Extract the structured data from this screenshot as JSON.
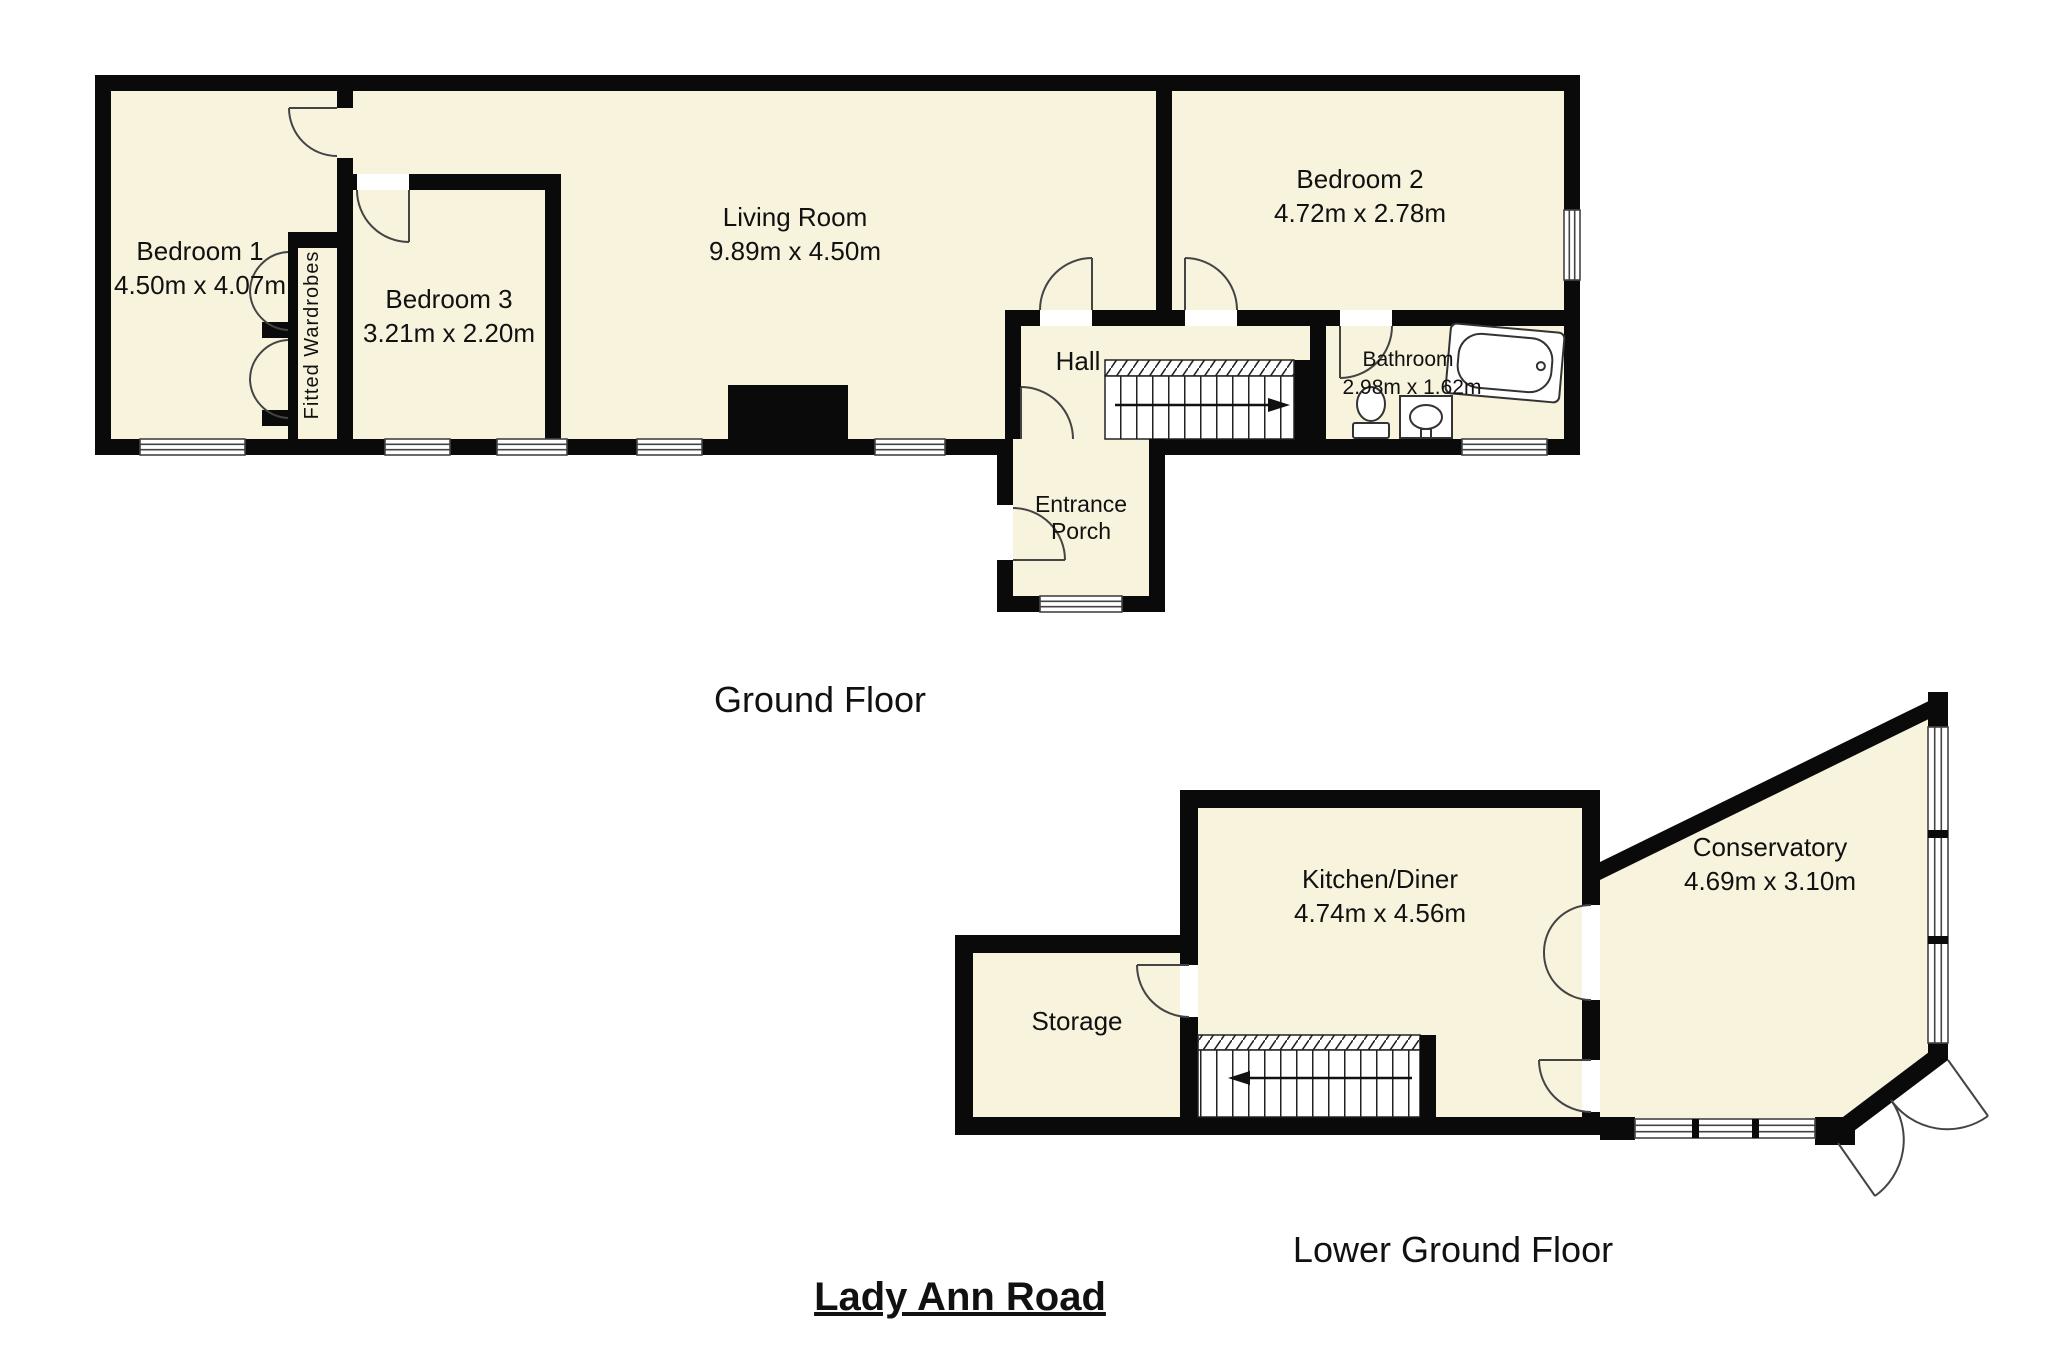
{
  "title": "Lady Ann Road",
  "colors": {
    "room_fill": "#f7f3dc",
    "wall": "#0a0a0a",
    "background": "#ffffff"
  },
  "floors": [
    {
      "label": "Ground Floor",
      "rooms": [
        {
          "name": "Bedroom 1",
          "dims": "4.50m x 4.07m"
        },
        {
          "name": "Bedroom 3",
          "dims": "3.21m x 2.20m"
        },
        {
          "name": "Living Room",
          "dims": "9.89m x 4.50m"
        },
        {
          "name": "Bedroom 2",
          "dims": "4.72m x 2.78m"
        },
        {
          "name": "Hall",
          "dims": ""
        },
        {
          "name": "Bathroom",
          "dims": "2.98m x 1.62m"
        },
        {
          "name": "Entrance Porch",
          "dims": "",
          "display_lines": [
            "Entrance",
            "Porch"
          ]
        },
        {
          "name": "Fitted Wardrobes",
          "dims": ""
        }
      ],
      "icons": [
        "bathtub-icon",
        "toilet-icon",
        "sink-icon",
        "stairs-up-right-icon",
        "door-swing-icon",
        "window-icon"
      ]
    },
    {
      "label": "Lower Ground Floor",
      "rooms": [
        {
          "name": "Kitchen/Diner",
          "dims": "4.74m x 4.56m"
        },
        {
          "name": "Storage",
          "dims": ""
        },
        {
          "name": "Conservatory",
          "dims": "4.69m x 3.10m"
        }
      ],
      "icons": [
        "stairs-down-left-icon",
        "french-doors-icon",
        "double-patio-doors-icon",
        "window-icon"
      ]
    }
  ]
}
